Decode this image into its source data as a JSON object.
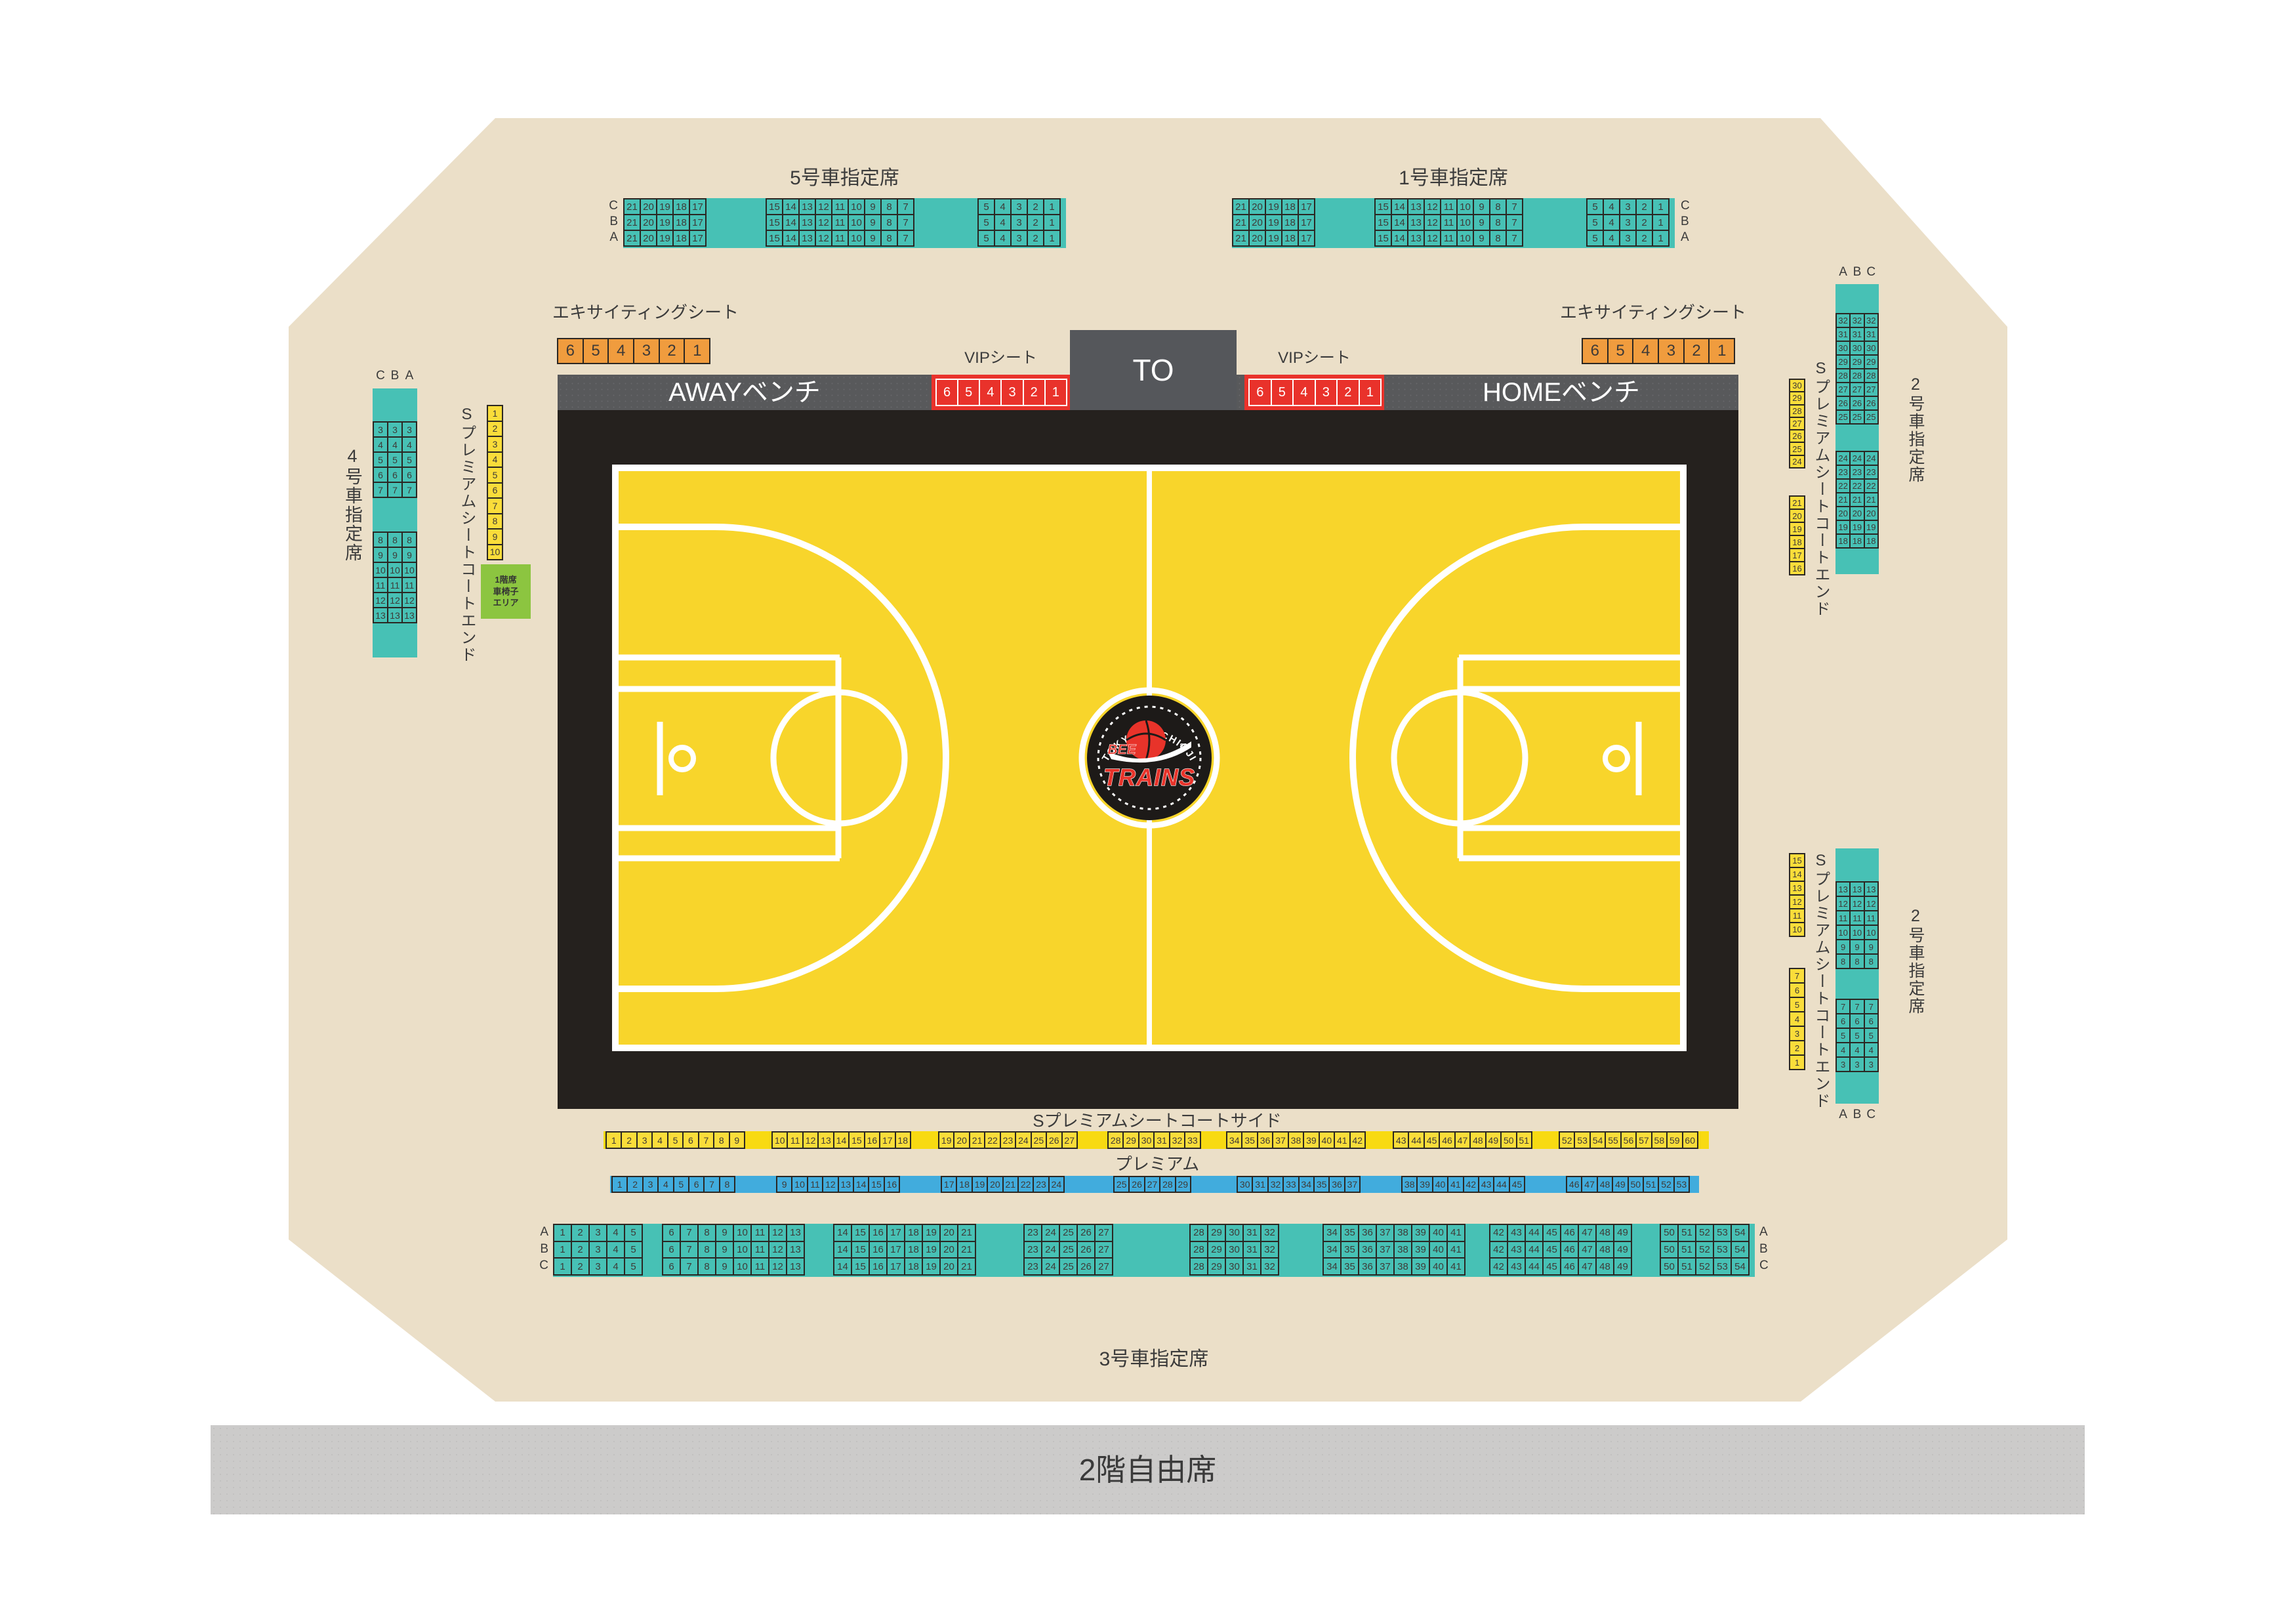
{
  "arena": {
    "colors": {
      "floor_beige": "#EBDFC8",
      "teal": "#47C1B5",
      "premium_yellow_seat": "#FADD3A",
      "premium_yellow_band": "#F8DA12",
      "premium_blue": "#41ACDD",
      "exciting_orange": "#F09C3E",
      "vip_red": "#E9322B",
      "wheelchair_green": "#8CC540",
      "court_yellow": "#F8D52B",
      "court_black": "#25211E",
      "bench_gray": "#58595B",
      "free_seating_gray": "#CCCBCA"
    },
    "car5": {
      "title": "5号車指定席",
      "row_labels": [
        "C",
        "B",
        "A"
      ],
      "groups": [
        [
          "21",
          "20",
          "19",
          "18",
          "17"
        ],
        [
          "15",
          "14",
          "13",
          "12",
          "11",
          "10",
          "9",
          "8",
          "7"
        ],
        [
          "5",
          "4",
          "3",
          "2",
          "1"
        ]
      ]
    },
    "car1": {
      "title": "1号車指定席",
      "row_labels": [
        "C",
        "B",
        "A"
      ],
      "groups": [
        [
          "21",
          "20",
          "19",
          "18",
          "17"
        ],
        [
          "15",
          "14",
          "13",
          "12",
          "11",
          "10",
          "9",
          "8",
          "7"
        ],
        [
          "5",
          "4",
          "3",
          "2",
          "1"
        ]
      ]
    },
    "exciting_left": {
      "label": "エキサイティングシート",
      "seats": [
        "6",
        "5",
        "4",
        "3",
        "2",
        "1"
      ]
    },
    "exciting_right": {
      "label": "エキサイティングシート",
      "seats": [
        "6",
        "5",
        "4",
        "3",
        "2",
        "1"
      ]
    },
    "vip_left": {
      "label": "VIPシート",
      "seats": [
        "6",
        "5",
        "4",
        "3",
        "2",
        "1"
      ]
    },
    "vip_right": {
      "label": "VIPシート",
      "seats": [
        "6",
        "5",
        "4",
        "3",
        "2",
        "1"
      ]
    },
    "bench_away": "AWAYベンチ",
    "bench_home": "HOMEベンチ",
    "to_label": "TO",
    "logo": {
      "arc": "TOKYO HACHIOJI",
      "bee": "BEE",
      "trains": "TRAINS",
      "num": "802"
    },
    "car4": {
      "title": "4号車指定席",
      "col_labels": [
        "C",
        "B",
        "A"
      ],
      "groups": [
        [
          "3",
          "4",
          "5",
          "6",
          "7"
        ],
        [
          "8",
          "9",
          "10",
          "11",
          "12",
          "13"
        ]
      ]
    },
    "sp_end_left": {
      "label": "Sプレミアムシートコートエンド",
      "seats": [
        "1",
        "2",
        "3",
        "4",
        "5",
        "6",
        "7",
        "8",
        "9",
        "10"
      ]
    },
    "wheelchair": {
      "label": "1階席\n車椅子\nエリア"
    },
    "car2_upper": {
      "title": "2号車指定席",
      "col_labels": [
        "A",
        "B",
        "C"
      ],
      "groups": [
        [
          "32",
          "31",
          "30",
          "29",
          "28",
          "27",
          "26",
          "25"
        ],
        [
          "24",
          "23",
          "22",
          "21",
          "20",
          "19",
          "18"
        ]
      ]
    },
    "car2_lower": {
      "title": "2号車指定席",
      "col_labels": [
        "A",
        "B",
        "C"
      ],
      "groups": [
        [
          "13",
          "12",
          "11",
          "10",
          "9",
          "8"
        ],
        [
          "7",
          "6",
          "5",
          "4",
          "3"
        ]
      ]
    },
    "sp_end_right_upper": {
      "label": "Sプレミアムシートコートエンド",
      "groups": [
        [
          "30",
          "29",
          "28",
          "27",
          "26",
          "25",
          "24"
        ],
        [
          "21",
          "20",
          "19",
          "18",
          "17",
          "16"
        ]
      ]
    },
    "sp_end_right_lower": {
      "label": "Sプレミアムシートコートエンド",
      "groups": [
        [
          "15",
          "14",
          "13",
          "12",
          "11",
          "10"
        ],
        [
          "7",
          "6",
          "5",
          "4",
          "3",
          "2",
          "1"
        ]
      ]
    },
    "sp_side": {
      "label": "Sプレミアムシートコートサイド",
      "groups": [
        [
          "1",
          "2",
          "3",
          "4",
          "5",
          "6",
          "7",
          "8",
          "9"
        ],
        [
          "10",
          "11",
          "12",
          "13",
          "14",
          "15",
          "16",
          "17",
          "18"
        ],
        [
          "19",
          "20",
          "21",
          "22",
          "23",
          "24",
          "25",
          "26",
          "27"
        ],
        [
          "28",
          "29",
          "30",
          "31",
          "32",
          "33"
        ],
        [
          "34",
          "35",
          "36",
          "37",
          "38",
          "39",
          "40",
          "41",
          "42"
        ],
        [
          "43",
          "44",
          "45",
          "46",
          "47",
          "48",
          "49",
          "50",
          "51"
        ],
        [
          "52",
          "53",
          "54",
          "55",
          "56",
          "57",
          "58",
          "59",
          "60"
        ]
      ]
    },
    "premium": {
      "label": "プレミアム",
      "groups": [
        [
          "1",
          "2",
          "3",
          "4",
          "5",
          "6",
          "7",
          "8"
        ],
        [
          "9",
          "10",
          "11",
          "12",
          "13",
          "14",
          "15",
          "16"
        ],
        [
          "17",
          "18",
          "19",
          "20",
          "21",
          "22",
          "23",
          "24"
        ],
        [
          "25",
          "26",
          "27",
          "28",
          "29"
        ],
        [
          "30",
          "31",
          "32",
          "33",
          "34",
          "35",
          "36",
          "37"
        ],
        [
          "38",
          "39",
          "40",
          "41",
          "42",
          "43",
          "44",
          "45"
        ],
        [
          "46",
          "47",
          "48",
          "49",
          "50",
          "51",
          "52",
          "53"
        ]
      ]
    },
    "car3": {
      "title": "3号車指定席",
      "row_labels": [
        "A",
        "B",
        "C"
      ],
      "groups": [
        [
          "1",
          "2",
          "3",
          "4",
          "5"
        ],
        [
          "6",
          "7",
          "8",
          "9",
          "10",
          "11",
          "12",
          "13"
        ],
        [
          "14",
          "15",
          "16",
          "17",
          "18",
          "19",
          "20",
          "21"
        ],
        [
          "23",
          "24",
          "25",
          "26",
          "27"
        ],
        [
          "28",
          "29",
          "30",
          "31",
          "32"
        ],
        [
          "34",
          "35",
          "36",
          "37",
          "38",
          "39",
          "40",
          "41"
        ],
        [
          "42",
          "43",
          "44",
          "45",
          "46",
          "47",
          "48",
          "49"
        ],
        [
          "50",
          "51",
          "52",
          "53",
          "54"
        ]
      ]
    },
    "second_floor": {
      "label": "2階自由席"
    }
  }
}
